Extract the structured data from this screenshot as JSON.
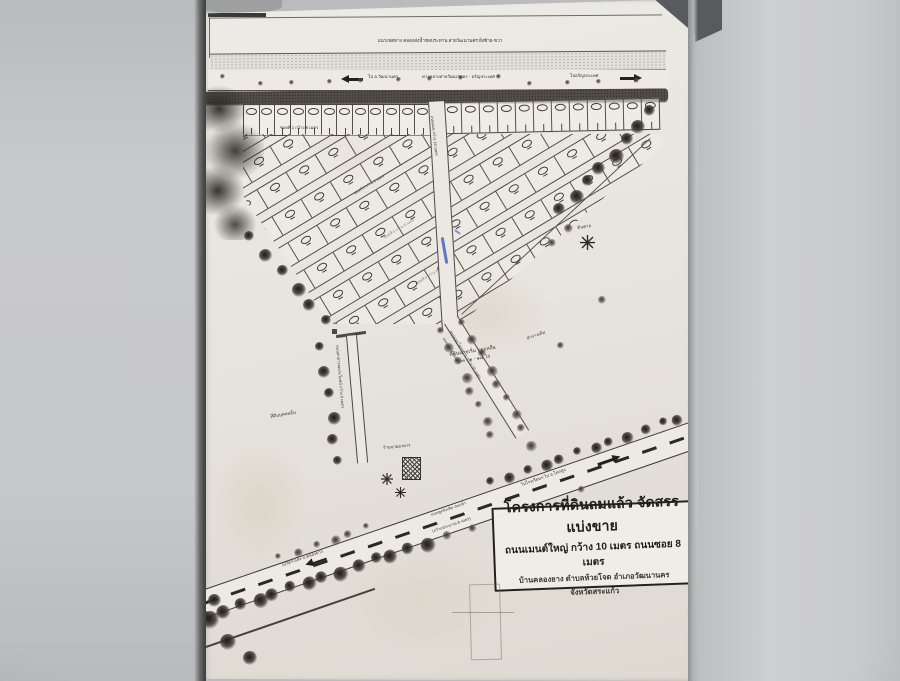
{
  "photo": {
    "background_color": "#c6c7c9",
    "paper_color": "#e9e6e0",
    "ink_color": "#34322c"
  },
  "icons": {
    "arrow_left": "left-road-arrow",
    "arrow_right": "right-road-arrow",
    "tree": "round-tree-clump",
    "palm_tree": "asterisk-star-tree",
    "shop_building": "hatched-square-building"
  },
  "plan": {
    "canal_label": "แนวเขตทาง คลองส่งน้ำชลประทาน สายวัฒนานคร ฝั่งซ้าย-ขวา",
    "highway": {
      "to_left": "ไป อ.วัฒนานคร",
      "name": "ทางหลวงสายวัฒนานคร - อรัญประเทศ",
      "to_right": "ไปอรัญประเทศ"
    },
    "soi1_label": "ซอยที่ 1 กว้าง 8 เมตร",
    "soi_labels": [
      "ซอยที่ 2 กว้าง 8 เมตร",
      "ซอยที่ 3 กว้าง 8 เมตร",
      "ซอยที่ 4 กว้าง 8 เมตร"
    ],
    "main_road_top_label": "ถนนเมน กว้าง 10 เมตร",
    "main_road_label_1": "ถนนเมนโครงการ กว้าง 10 เมตร",
    "main_road_label_2": "ถนนลูกรัง ถมแล้ว",
    "left_road_label": "ถนนสาธารณประโยชน์ กว้าง 6 เมตร",
    "parcel_line1": "ที่ดินนายเริ่ม บุญเหลือ",
    "parcel_line2": "๘๓ - ๑ - ๑๔ ไร่",
    "palm_label": "ต้นตาล",
    "ditch_label": "ลำรางเดิม",
    "other_land_label": "ที่ดินบุคคลอื่น",
    "shop_label": "ร้านขายอาหาร",
    "bottom_road": {
      "to_left": "ไปวัดฯ และ บ.คลองยาง",
      "name_1": "ถนนลูกรังเดิม ถมแล้ว",
      "name_2": "(กว้างประมาณ 8 เมตร)",
      "to_right": "ไปโรงเรียนฯ ไป อ.โคกสูง"
    }
  },
  "title_box": {
    "line1": "โครงการที่ดินถมแล้ว จัดสรรแบ่งขาย",
    "line2": "ถนนเมนต์ใหญ่ กว้าง 10 เมตร ถนนซอย 8 เมตร",
    "line3": "บ้านคลองยาง ตำบลห้วยโจด อำเภอวัฒนานคร",
    "line4": "จังหวัดสระแก้ว"
  }
}
